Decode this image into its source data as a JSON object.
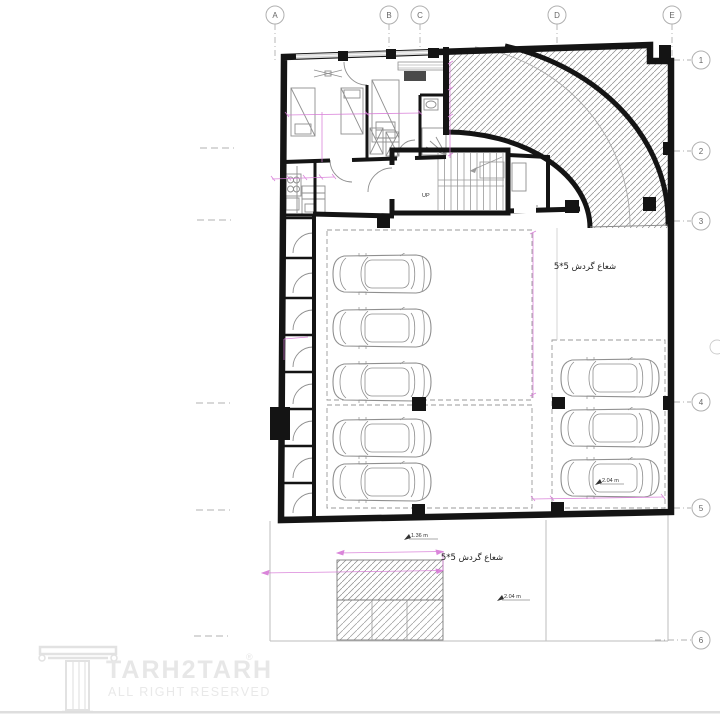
{
  "colors": {
    "background": "#ffffff",
    "wall": "#141414",
    "furniture_line": "#8f8f8f",
    "hatch_line": "#7a7a7a",
    "grid_line": "#b0b0b0",
    "dimension_magenta": "#d678d6",
    "watermark_gray": "#e7e7e7"
  },
  "grid": {
    "top": [
      {
        "label": "A",
        "x": 275
      },
      {
        "label": "B",
        "x": 389
      },
      {
        "label": "C",
        "x": 420
      },
      {
        "label": "D",
        "x": 557
      },
      {
        "label": "E",
        "x": 672
      }
    ],
    "right": [
      {
        "label": "1",
        "y": 60
      },
      {
        "label": "2",
        "y": 151
      },
      {
        "label": "3",
        "y": 221
      },
      {
        "label": "4",
        "y": 402
      },
      {
        "label": "5",
        "y": 508
      },
      {
        "label": "6",
        "y": 640
      }
    ]
  },
  "labels": {
    "turning_radius_parking": "شعاع گردش 5*5",
    "turning_radius_yard": "شعاع گردش 5*5",
    "stairs_up": "UP",
    "yard_dim": "1.36 m",
    "yard_clearance": "2.04 m",
    "parking_clearance": "2.04 m"
  },
  "watermark": {
    "brand": "TARH2TARH",
    "registered": "®",
    "tagline": "ALL RIGHT RESERVED"
  },
  "parking": {
    "left_top_cars": 3,
    "left_bottom_cars": 2,
    "right_cars": 3,
    "storage_cells": 8
  }
}
